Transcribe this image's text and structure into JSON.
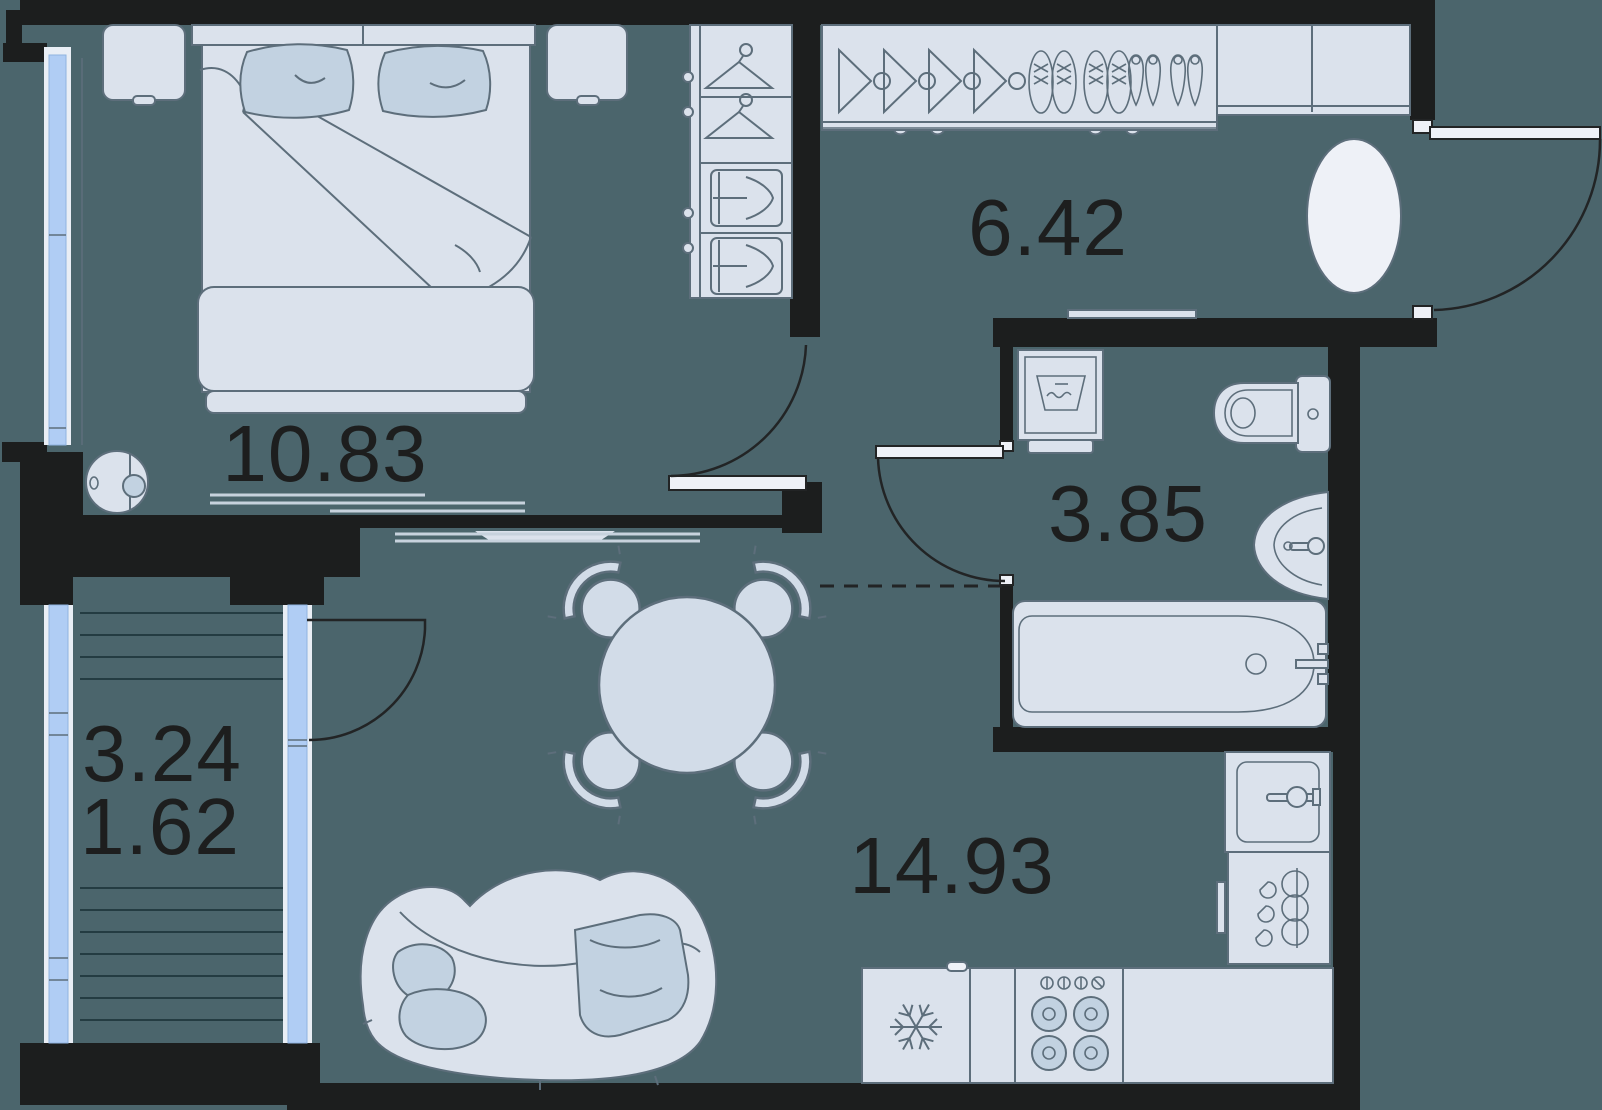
{
  "title": "1-room apartment floor plan",
  "rooms": {
    "bedroom": {
      "area": "10.83"
    },
    "hallway": {
      "area": "6.42"
    },
    "bathroom": {
      "area": "3.85"
    },
    "living_kitchen": {
      "area": "14.93"
    },
    "balcony": {
      "area_full": "3.24",
      "area_reduced": "1.62"
    }
  },
  "colors": {
    "bg": "#4b656c",
    "wall": "#1c1e1e",
    "fill": "#dbe2ec",
    "fillb": "#eef1f7",
    "accent": "#c2d2e1",
    "stroke": "#5d6e7b",
    "window": "#b0cdf4",
    "frame": "#e9eef5",
    "text": "#1d1e1e",
    "deck": "#243c42",
    "rugline": "#c7d2dd",
    "table": "#d2dce8"
  }
}
